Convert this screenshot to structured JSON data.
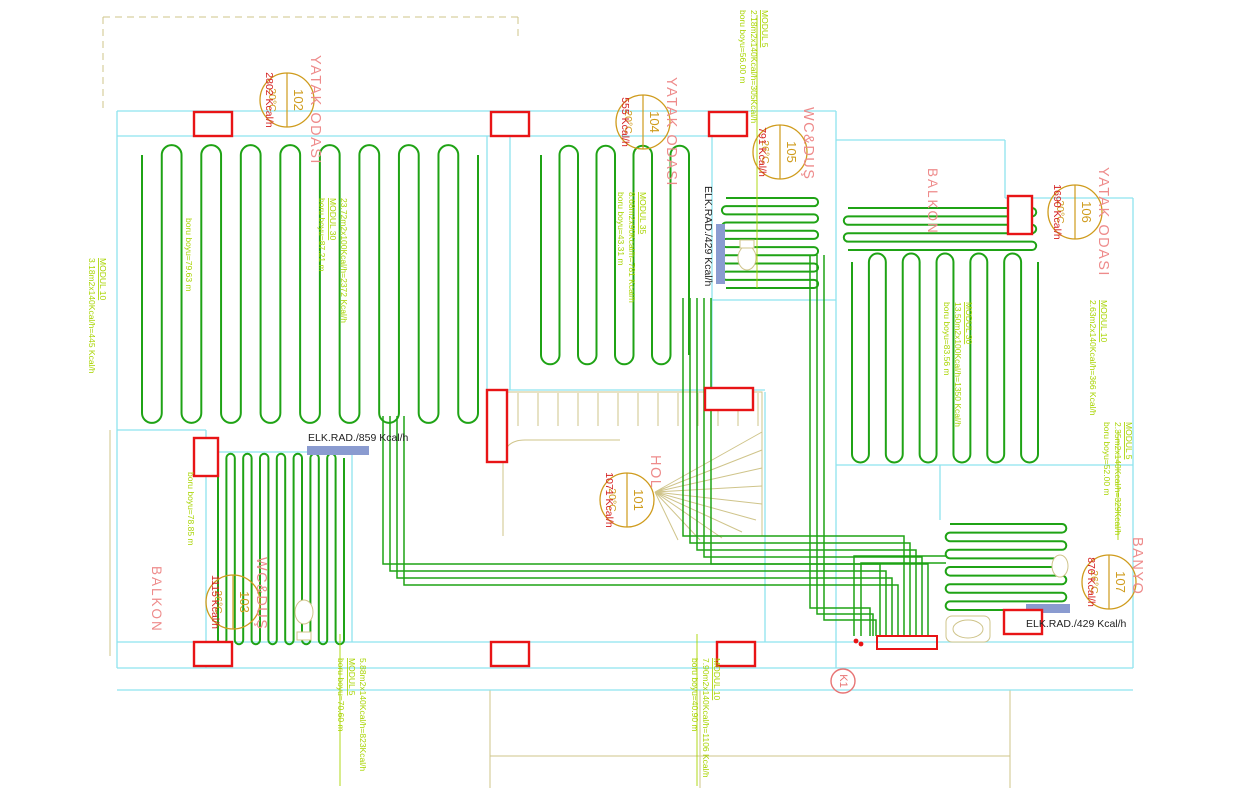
{
  "colors": {
    "pipe": "#1fa315",
    "wall": "#8ee3ef",
    "thin": "#cfc48a",
    "annotation": "#a8d400",
    "red": "#e81416",
    "salmon": "#ee8b8b",
    "tag": "#cf9b1c",
    "kcal": "#d42020",
    "black": "#222222",
    "radiator": "#8a9bd0",
    "k1": "#e87474"
  },
  "rooms": [
    {
      "id": "101",
      "name": "HOL",
      "temp": "20°C",
      "load": "1071 Kcal/h",
      "cx": 627,
      "cy": 500
    },
    {
      "id": "102",
      "name": "YATAK ODASI",
      "temp": "20°C",
      "load": "2802 Kcal/h",
      "cx": 287,
      "cy": 100
    },
    {
      "id": "103",
      "name": "WC&DUŞ",
      "temp": "26°C",
      "load": "1115 Kcal/h",
      "cx": 233,
      "cy": 602
    },
    {
      "id": "104",
      "name": "YATAK ODASI",
      "temp": "20°C",
      "load": "555 Kcal/h",
      "cx": 643,
      "cy": 122
    },
    {
      "id": "105",
      "name": "WC&DUŞ",
      "temp": "26°C",
      "load": "791 Kcal/h",
      "cx": 780,
      "cy": 152
    },
    {
      "id": "106",
      "name": "YATAK ODASI",
      "temp": "20°C",
      "load": "1690 Kcal/h",
      "cx": 1075,
      "cy": 212
    },
    {
      "id": "107",
      "name": "BANYO",
      "temp": "26°C",
      "load": "870 Kcal/h",
      "cx": 1109,
      "cy": 582
    }
  ],
  "balconies": [
    {
      "name": "BALKON",
      "x": 928,
      "y": 168
    },
    {
      "name": "BALKON",
      "x": 152,
      "y": 566
    }
  ],
  "annotations": [
    {
      "lines": [
        "MODUL 10",
        "3.18m2x140Kcal/h=445 Kcal/h"
      ],
      "x": 100,
      "y": 258
    },
    {
      "lines": [
        "boru boyu=79.63 m"
      ],
      "x": 186,
      "y": 218
    },
    {
      "lines": [
        "23.72m2x100Kcal/h=2372 Kcal/h",
        "MODUL 30",
        "boru boyu=87.21 m"
      ],
      "x": 341,
      "y": 198
    },
    {
      "lines": [
        "MODUL 35",
        "8.68m2x90Kcal/h=781 Kcal/h",
        "boru boyu=43.31 m"
      ],
      "x": 640,
      "y": 192
    },
    {
      "lines": [
        "MODUL 5",
        "2.18m2x140Kcal/h=305Kcal/h",
        "boru boyu=56.00 m"
      ],
      "x": 762,
      "y": 10,
      "leader": [
        757,
        15,
        288
      ]
    },
    {
      "lines": [
        "MODUL 30",
        "13.50m2x100Kcal/h=1350 Kcal/h",
        "boru boyu=83.56 m"
      ],
      "x": 966,
      "y": 302
    },
    {
      "lines": [
        "MODUL 10",
        "2.63m2x140Kcal/h=366 Kcal/h"
      ],
      "x": 1101,
      "y": 300
    },
    {
      "lines": [
        "MODUL 5",
        "2.35m2x140Kcal/h=329Kcal/h",
        "boru boyu=52.00 m"
      ],
      "x": 1126,
      "y": 422,
      "leader": [
        1118,
        430,
        540
      ]
    },
    {
      "lines": [
        "boru boyu=78.85 m"
      ],
      "x": 188,
      "y": 472
    },
    {
      "lines": [
        "5.88m2x140Kcal/h=823Kcal/h",
        "MODUL 5",
        "boru boyu=70.60 m"
      ],
      "x": 360,
      "y": 658,
      "leader": [
        340,
        634,
        786
      ]
    },
    {
      "lines": [
        "MODUL 10",
        "7.90m2x140Kcal/h=1106 Kcal/h",
        "boru boyu=40.90 m"
      ],
      "x": 714,
      "y": 658,
      "leader": [
        697,
        634,
        786
      ]
    }
  ],
  "elk_rad_labels": [
    {
      "text": "ELK.RAD./859 Kcal/h",
      "x": 308,
      "y": 441,
      "rot": 0
    },
    {
      "text": "ELK.RAD./429 Kcal/h",
      "x": 705,
      "y": 186,
      "rot": 90
    },
    {
      "text": "ELK.RAD./429 Kcal/h",
      "x": 1026,
      "y": 627,
      "rot": 0
    }
  ],
  "distributor": {
    "label": "K1"
  }
}
